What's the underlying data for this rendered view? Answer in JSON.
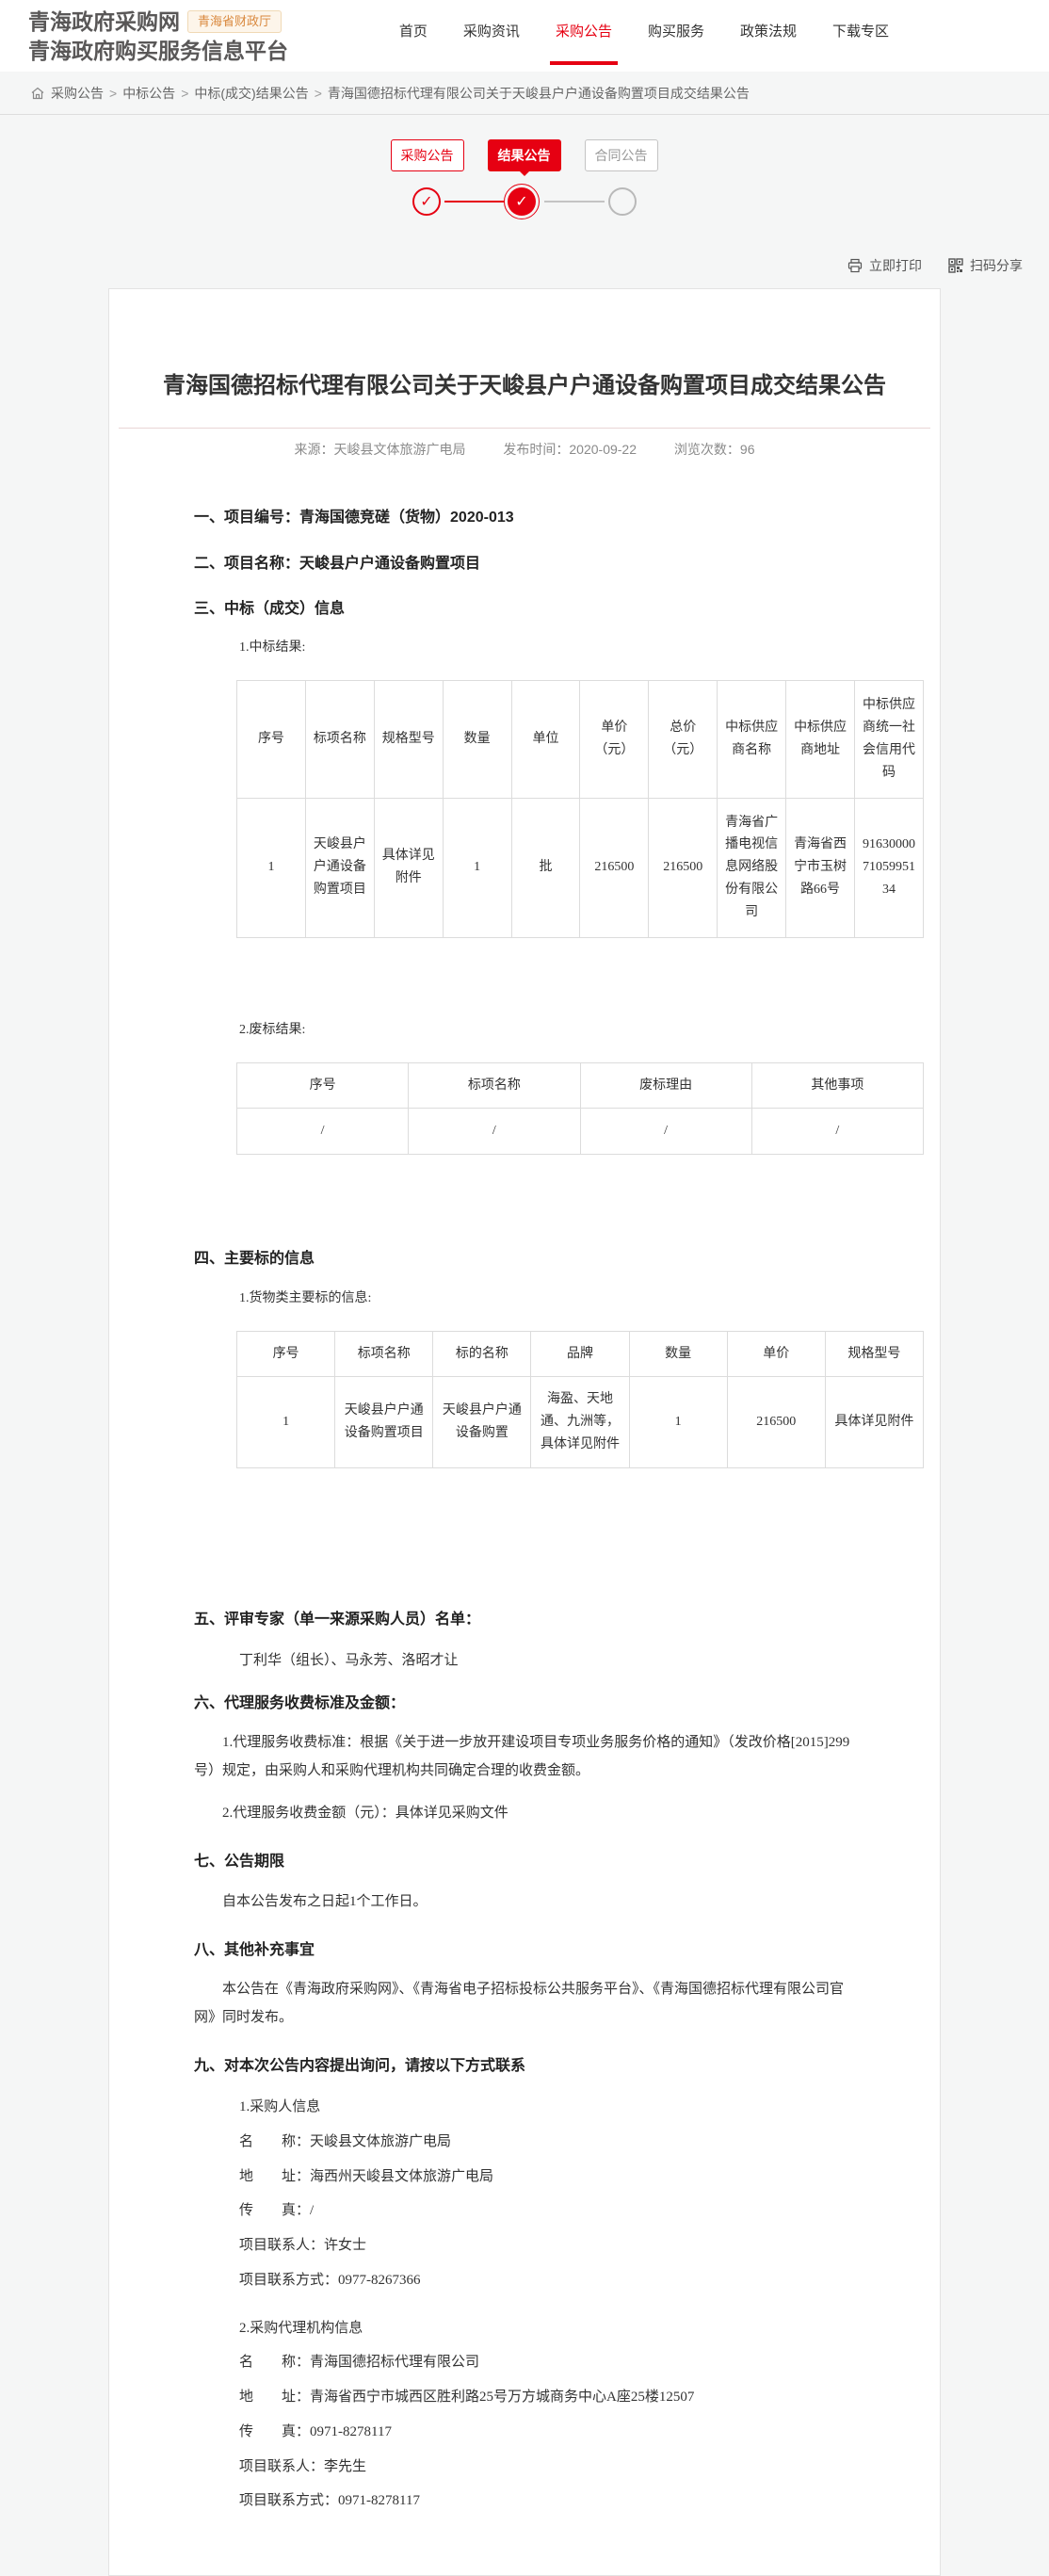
{
  "colors": {
    "accent_red": "#e60012",
    "badge_orange": "#d9883d",
    "logo_gray": "#595757",
    "page_bg": "#f5f6f6"
  },
  "header": {
    "logo_line1": "青海政府采购网",
    "logo_badge": "青海省财政厅",
    "logo_line2": "青海政府购买服务信息平台",
    "nav": [
      {
        "label": "首页"
      },
      {
        "label": "采购资讯"
      },
      {
        "label": "采购公告"
      },
      {
        "label": "购买服务"
      },
      {
        "label": "政策法规"
      },
      {
        "label": "下载专区"
      }
    ]
  },
  "breadcrumb": {
    "separator": ">",
    "items": [
      "采购公告",
      "中标公告",
      "中标(成交)结果公告",
      "青海国德招标代理有限公司关于天峻县户户通设备购置项目成交结果公告"
    ]
  },
  "stepper": {
    "check_glyph": "✓",
    "steps": [
      {
        "label": "采购公告",
        "state": "done"
      },
      {
        "label": "结果公告",
        "state": "current"
      },
      {
        "label": "合同公告",
        "state": "pending"
      }
    ]
  },
  "toolbar": {
    "print_label": "立即打印",
    "share_label": "扫码分享"
  },
  "article": {
    "title": "青海国德招标代理有限公司关于天峻县户户通设备购置项目成交结果公告",
    "meta": {
      "source_label": "来源：",
      "source": "天峻县文体旅游广电局",
      "publish_label": "发布时间：",
      "publish_date": "2020-09-22",
      "views_label": "浏览次数：",
      "views": "96"
    },
    "s1": {
      "heading": "一、项目编号：",
      "value": "青海国德竞磋（货物）2020-013"
    },
    "s2": {
      "heading": "二、项目名称：",
      "value": "天峻县户户通设备购置项目"
    },
    "s3": {
      "heading": "三、中标（成交）信息",
      "sub1": "1.中标结果:",
      "sub2": "2.废标结果:"
    },
    "award_table": {
      "headers": [
        "序号",
        "标项名称",
        "规格型号",
        "数量",
        "单位",
        "单价（元）",
        "总价（元）",
        "中标供应商名称",
        "中标供应商地址",
        "中标供应商统一社会信用代码"
      ],
      "rows": [
        [
          "1",
          "天峻县户户通设备购置项目",
          "具体详见附件",
          "1",
          "批",
          "216500",
          "216500",
          "青海省广播电视信息网络股份有限公司",
          "青海省西宁市玉树路66号",
          "916300007105995134"
        ]
      ]
    },
    "failed_table": {
      "headers": [
        "序号",
        "标项名称",
        "废标理由",
        "其他事项"
      ],
      "rows": [
        [
          "/",
          "/",
          "/",
          "/"
        ]
      ]
    },
    "s4": {
      "heading": "四、主要标的信息",
      "sub1": "1.货物类主要标的信息:"
    },
    "subject_table": {
      "headers": [
        "序号",
        "标项名称",
        "标的名称",
        "品牌",
        "数量",
        "单价",
        "规格型号"
      ],
      "rows": [
        [
          "1",
          "天峻县户户通设备购置项目",
          "天峻县户户通设备购置",
          "海盈、天地通、九洲等，具体详见附件",
          "1",
          "216500",
          "具体详见附件"
        ]
      ]
    },
    "s5": {
      "heading": "五、评审专家（单一来源采购人员）名单：",
      "names": "丁利华（组长）、马永芳、洛昭才让"
    },
    "s6": {
      "heading": "六、代理服务收费标准及金额：",
      "p1": "1.代理服务收费标准：根据《关于进一步放开建设项目专项业务服务价格的通知》（发改价格[2015]299号）规定，由采购人和采购代理机构共同确定合理的收费金额。",
      "p2": "2.代理服务收费金额（元）：具体详见采购文件"
    },
    "s7": {
      "heading": "七、公告期限",
      "p1": "自本公告发布之日起1个工作日。"
    },
    "s8": {
      "heading": "八、其他补充事宜",
      "p1": "本公告在《青海政府采购网》、《青海省电子招标投标公共服务平台》、《青海国德招标代理有限公司官网》同时发布。"
    },
    "s9": {
      "heading": "九、对本次公告内容提出询问，请按以下方式联系"
    },
    "purchaser": {
      "title": "1.采购人信息",
      "lines": [
        "名　　称：天峻县文体旅游广电局",
        "地　　址：海西州天峻县文体旅游广电局",
        "传　　真：/",
        "项目联系人：许女士",
        "项目联系方式：0977-8267366"
      ]
    },
    "agency": {
      "title": "2.采购代理机构信息",
      "lines": [
        "名　　称：青海国德招标代理有限公司",
        "地　　址：青海省西宁市城西区胜利路25号万方城商务中心A座25楼12507",
        "传　　真：0971-8278117",
        "项目联系人：李先生",
        "项目联系方式：0971-8278117"
      ]
    }
  }
}
